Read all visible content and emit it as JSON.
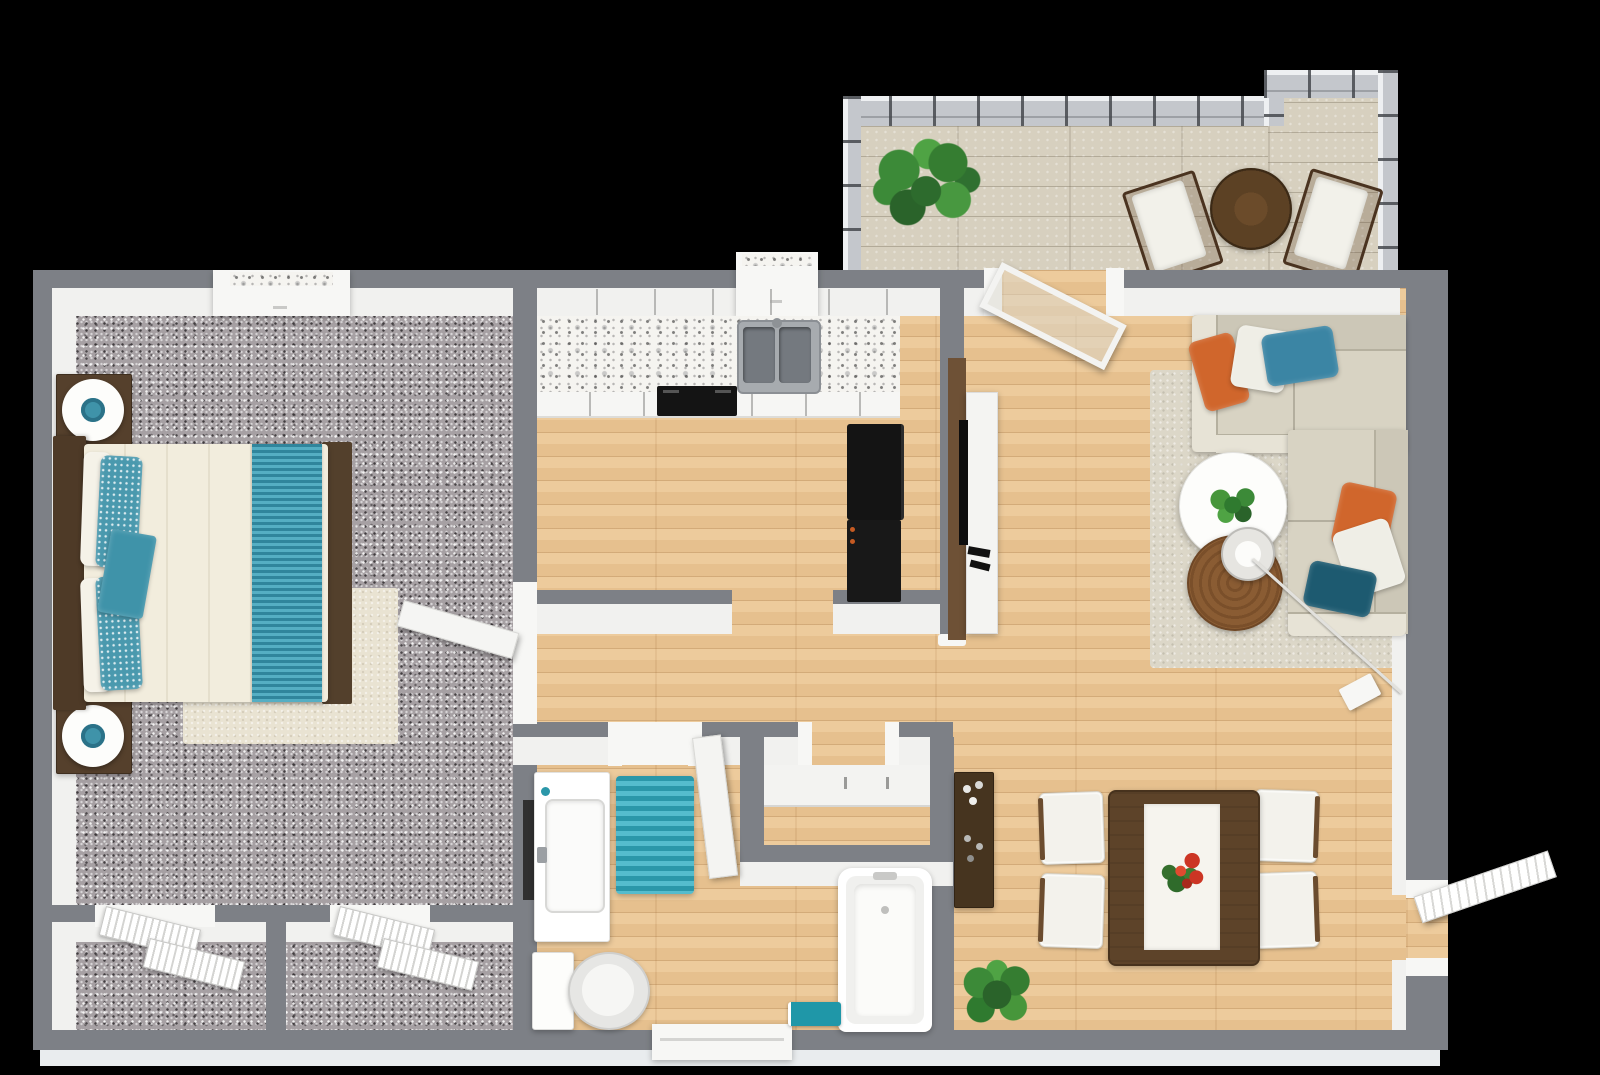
{
  "title": "3D apartment floor plan — top-down render",
  "colors": {
    "background": "#000000",
    "wall": "#7d8086",
    "wall-face": "#f1f1ef",
    "wall-outer": "#e9ecee",
    "wood": "#ecc795",
    "carpet": "#a6a0a3",
    "deck": "#d7d0bf",
    "rail": "#c4c7cc",
    "marble-base": "#f5f4f0",
    "white": "#f7f7f5",
    "appliance": "#141414",
    "steel": "#a7abaf",
    "steel-dark": "#74797f",
    "wood-dark": "#55402c",
    "wood-table": "#5d4329",
    "wood-bar": "#46341f",
    "wood-poof": "#8a5c33",
    "wood-bistro": "#5c4124",
    "wood-tv": "#6e5136",
    "bed-white": "#f2eddd",
    "teal": "#3f93a9",
    "teal-sparkle": "#4a99ae",
    "teal-dark": "#1d5a70",
    "teal-rug": "#2b97a9",
    "teal-pillow": "#3b85a4",
    "orange": "#d0662c",
    "sofa-body": "#d8d3c3",
    "sofa-back": "#ccc7b7",
    "sofa-light": "#e7e3d6",
    "rug-cream": "#e9e3d2",
    "rug-shag": "#dcd7c8",
    "green": "#3c8a38",
    "green-dark": "#256325",
    "red": "#cc3524"
  },
  "floorplan": {
    "view": "top-down 3D render of a one-bedroom apartment",
    "rooms": [
      {
        "name": "bedroom",
        "floor": "gray speckled carpet",
        "items": [
          "bed with white comforter and teal runner",
          "teal and white pillows",
          "two dark-wood nightstands",
          "two round white lamps with teal centers",
          "cream area rug",
          "window",
          "open door"
        ]
      },
      {
        "name": "bedroom-closets",
        "floor": "gray speckled carpet",
        "items": [
          "two closets with white louvered doors"
        ]
      },
      {
        "name": "kitchen",
        "floor": "light wood plank",
        "items": [
          "white cabinets with marble counter",
          "double stainless sink",
          "black range",
          "black refrigerator",
          "window"
        ]
      },
      {
        "name": "hallway",
        "floor": "light wood plank",
        "items": [
          "linen closet with shelf and rod"
        ]
      },
      {
        "name": "bathroom",
        "floor": "light wood plank",
        "items": [
          "white vanity with sink",
          "dark wall mirror",
          "teal striped rug",
          "toilet",
          "bathtub",
          "teal bath mat",
          "window",
          "open door"
        ]
      },
      {
        "name": "living-dining",
        "floor": "light wood plank",
        "items": [
          "L-shaped sectional sofa",
          "orange, white and teal throw pillows",
          "cream shag rug",
          "round white coffee table with plant",
          "round jute ottoman",
          "glass table lamp with arc stand",
          "TV console with wood accent panel",
          "bar cabinet with bottles",
          "dark-wood dining table with white runner and red flowers",
          "four white dining chairs",
          "potted plant",
          "open entry door"
        ]
      },
      {
        "name": "balcony",
        "floor": "whitewashed deck planks",
        "items": [
          "metal railing",
          "fern plant",
          "round bistro table",
          "two white sling chairs",
          "open glass door"
        ]
      }
    ]
  }
}
